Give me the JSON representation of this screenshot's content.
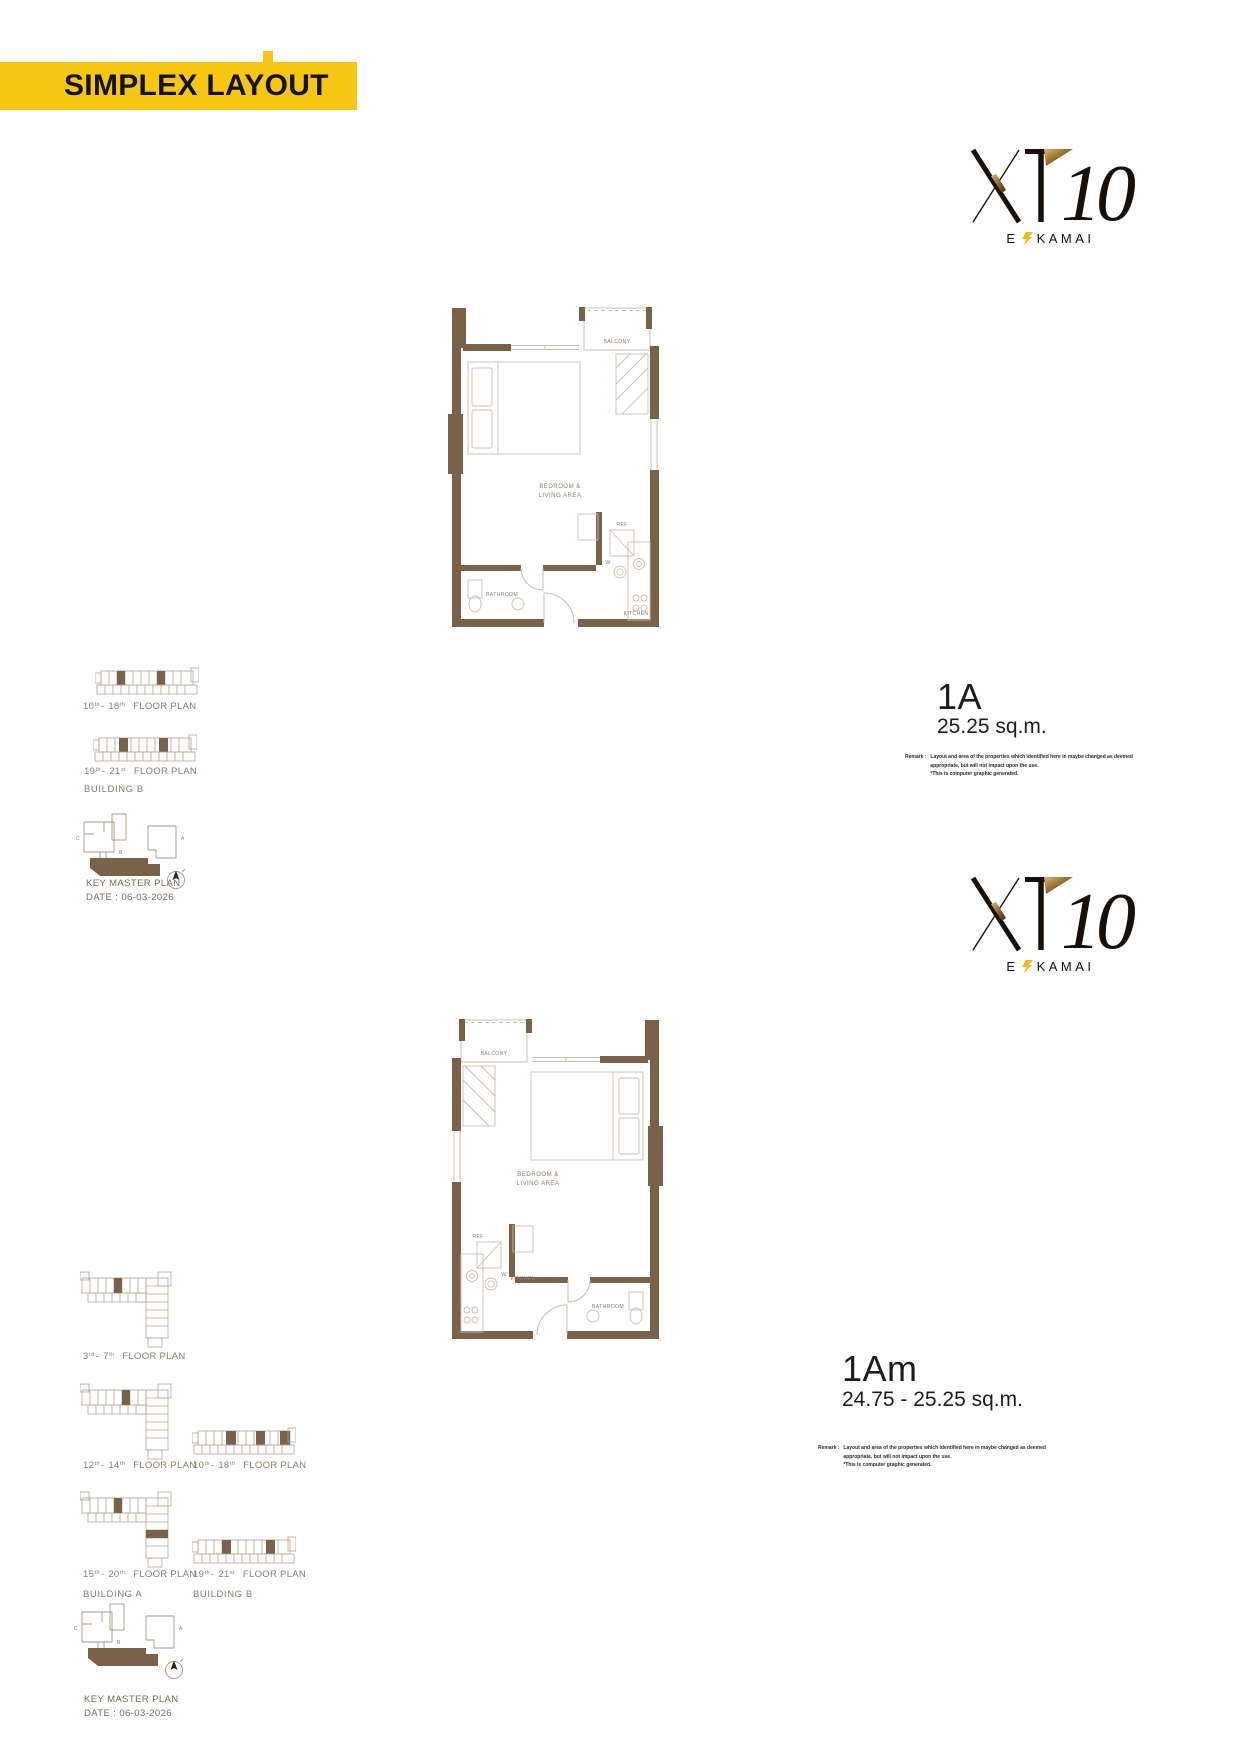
{
  "banner": {
    "title": "SIMPLEX LAYOUT"
  },
  "logo": {
    "xt": "XT",
    "ten": "10",
    "e": "E",
    "kamai": "KAMAI"
  },
  "remark": {
    "label": "Remark :",
    "line1": "Layout and area of the properties which identified here in maybe changed as deemed",
    "line2": "appropriate, but will not impact upon the use.",
    "line3": "*This is computer graphic generated."
  },
  "plan_labels": {
    "balcony": "BALCONY",
    "bedroom_line1": "BEDROOM &",
    "bedroom_line2": "LIVING AREA",
    "kitchen": "KITCHEN",
    "ref": "REF",
    "washer": "W",
    "bathroom": "BATHROOM"
  },
  "section1": {
    "unit_name": "1A",
    "unit_area": "25.25 sq.m.",
    "floors": [
      {
        "n1": "10",
        "s1": "th",
        "sep": "-",
        "n2": "18",
        "s2": "th",
        "label": "FLOOR PLAN"
      },
      {
        "n1": "19",
        "s1": "th",
        "sep": "-",
        "n2": "21",
        "s2": "st",
        "label": "FLOOR PLAN",
        "building": "BUILDING B"
      }
    ],
    "keyplan": {
      "title": "KEY MASTER PLAN",
      "date": "DATE : 06-03-2026",
      "c": "C",
      "a": "A",
      "b": "B"
    }
  },
  "section2": {
    "unit_name": "1Am",
    "unit_area": "24.75 - 25.25 sq.m.",
    "floors": [
      {
        "n1": "3",
        "s1": "rd",
        "sep": "-",
        "n2": "7",
        "s2": "th",
        "label": "FLOOR PLAN"
      },
      {
        "n1": "12",
        "s1": "th",
        "sep": "-",
        "n2": "14",
        "s2": "th",
        "label": "FLOOR PLAN"
      },
      {
        "n1": "10",
        "s1": "th",
        "sep": "-",
        "n2": "18",
        "s2": "th",
        "label": "FLOOR PLAN"
      },
      {
        "n1": "15",
        "s1": "th",
        "sep": "-",
        "n2": "20",
        "s2": "th",
        "label": "FLOOR PLAN",
        "building": "BUILDING A"
      },
      {
        "n1": "19",
        "s1": "th",
        "sep": "-",
        "n2": "21",
        "s2": "st",
        "label": "FLOOR PLAN",
        "building": "BUILDING B"
      }
    ],
    "keyplan": {
      "title": "KEY MASTER PLAN",
      "date": "DATE : 06-03-2026",
      "c": "C",
      "a": "A",
      "b": "B"
    }
  },
  "colors": {
    "banner_yellow": "#F7C614",
    "wall_brown": "#796249",
    "plan_line": "#C8BCAC",
    "plan_label": "#8D8173",
    "diagram_line": "#B3A593"
  }
}
